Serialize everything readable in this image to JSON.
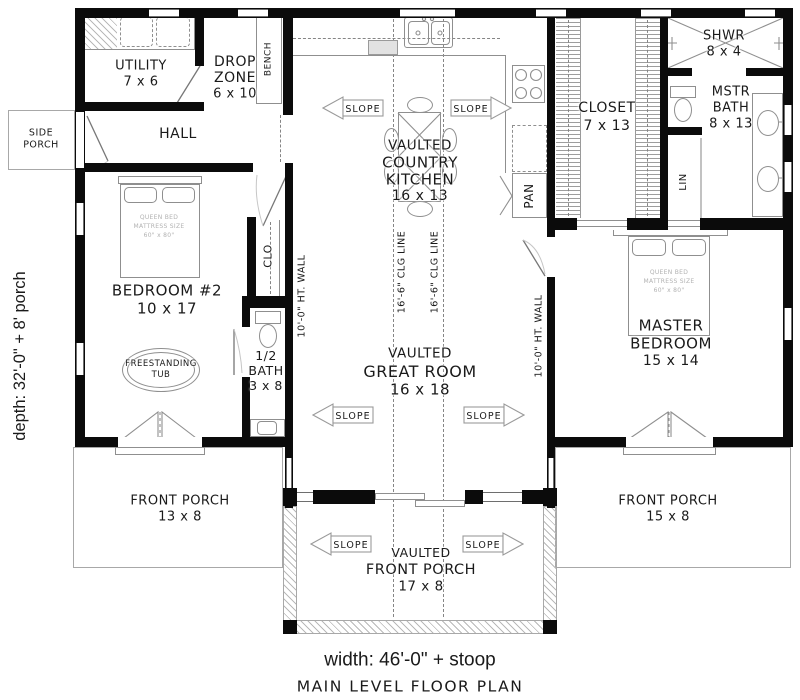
{
  "title": "MAIN LEVEL FLOOR PLAN",
  "dimensions": {
    "width_label": "width: 46'-0\" + stoop",
    "depth_label": "depth: 32'-0\" + 8' porch"
  },
  "rooms": {
    "utility": {
      "name": "UTILITY",
      "dims": "7 x 6"
    },
    "drop_zone": {
      "line1": "DROP",
      "line2": "ZONE",
      "dims": "6 x 10"
    },
    "hall": {
      "name": "HALL"
    },
    "side_porch": {
      "line1": "SIDE",
      "line2": "PORCH"
    },
    "bedroom2": {
      "name": "BEDROOM #2",
      "dims": "10 x 17"
    },
    "closet2": {
      "name": "CLO"
    },
    "half_bath": {
      "line1": "1/2",
      "line2": "BATH",
      "dims": "3 x 8"
    },
    "kitchen": {
      "line1": "VAULTED",
      "line2": "COUNTRY",
      "line3": "KITCHEN",
      "dims": "16 x 13"
    },
    "great_room": {
      "line1": "VAULTED",
      "line2": "GREAT ROOM",
      "dims": "16 x 18"
    },
    "master_closet": {
      "name": "CLOSET",
      "dims": "7 x 13"
    },
    "shower": {
      "name": "SHWR",
      "dims": "8 x 4"
    },
    "master_bath": {
      "line1": "MSTR",
      "line2": "BATH",
      "dims": "8 x 13"
    },
    "linen": {
      "name": "LIN"
    },
    "pantry": {
      "name": "PAN"
    },
    "bench": {
      "name": "BENCH"
    },
    "master_bedroom": {
      "line1": "MASTER",
      "line2": "BEDROOM",
      "dims": "15 x 14"
    },
    "front_porch_left": {
      "name": "FRONT PORCH",
      "dims": "13 x 8"
    },
    "front_porch_right": {
      "name": "FRONT PORCH",
      "dims": "15 x 8"
    },
    "front_porch_center": {
      "line1": "VAULTED",
      "line2": "FRONT PORCH",
      "dims": "17 x 8"
    }
  },
  "fixtures": {
    "tub": {
      "line1": "FREESTANDING",
      "line2": "TUB"
    },
    "queen_bed": {
      "line1": "QUEEN BED",
      "line2": "MATTRESS SIZE",
      "line3": "60\" x 80\""
    }
  },
  "annotations": {
    "slope": "SLOPE",
    "clg_line": "16'-6\" CLG LINE",
    "ht_wall": "10'-0\" HT. WALL"
  },
  "colors": {
    "wall": "#0b0b0b",
    "line": "#8f8f8f",
    "text": "#1a1a1a",
    "background": "#ffffff"
  }
}
